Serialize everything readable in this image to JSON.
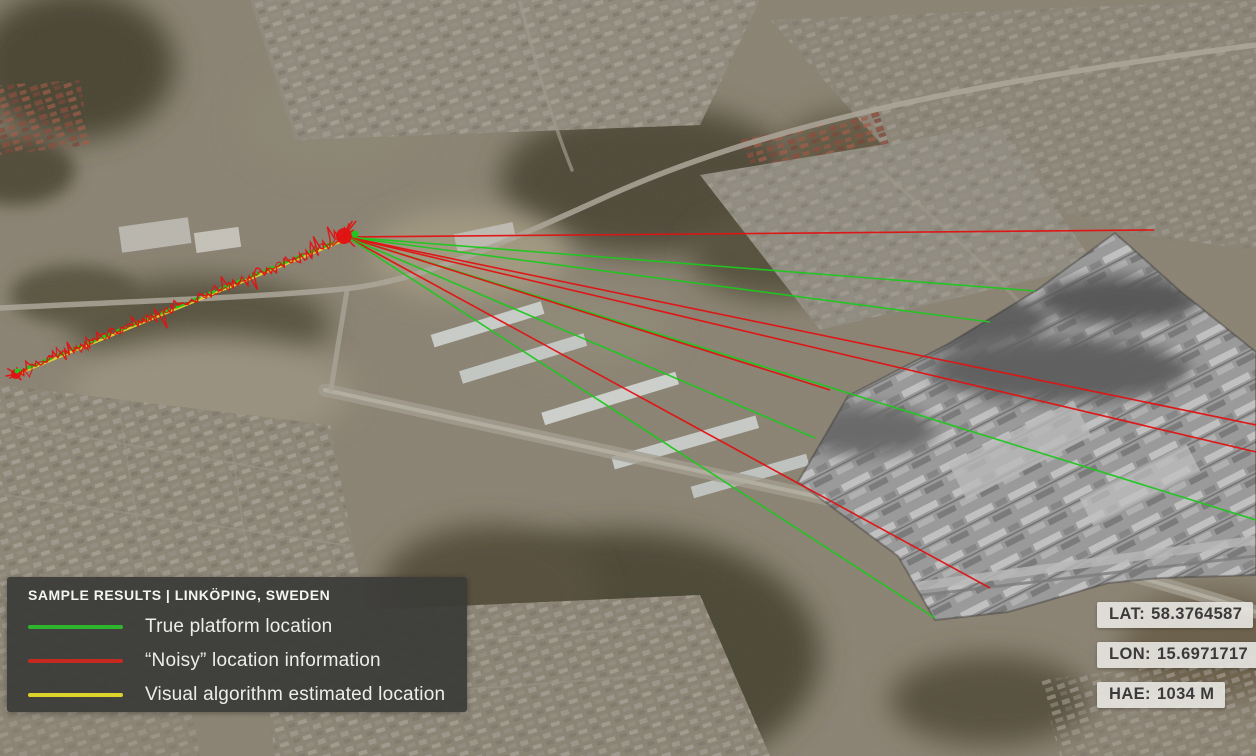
{
  "colors": {
    "green": "#1fc71f",
    "red": "#e11212",
    "yellow": "#e8da2e",
    "legend_bg": "rgba(60,59,56,0.94)",
    "badge_bg": "rgba(230,228,223,0.92)",
    "badge_text": "#3a3a3a"
  },
  "legend": {
    "title": "SAMPLE RESULTS | LINKÖPING, SWEDEN",
    "items": [
      {
        "label": "True platform location",
        "color": "#2db52d"
      },
      {
        "label": "“Noisy” location information",
        "color": "#c6291f"
      },
      {
        "label": "Visual algorithm estimated location",
        "color": "#ddd32b"
      }
    ]
  },
  "telemetry": {
    "badges": [
      {
        "label": "LAT:",
        "value": "58.3764587"
      },
      {
        "label": "LON:",
        "value": "15.6971717"
      },
      {
        "label": "HAE:",
        "value": "1034 M"
      }
    ]
  },
  "overlay": {
    "origin": {
      "x": 347,
      "y": 237
    },
    "rays": [
      {
        "color": "red",
        "x2": 1154,
        "y2": 230
      },
      {
        "color": "green",
        "x2": 1035,
        "y2": 291
      },
      {
        "color": "green",
        "x2": 990,
        "y2": 322
      },
      {
        "color": "red",
        "x2": 1256,
        "y2": 425
      },
      {
        "color": "red",
        "x2": 1256,
        "y2": 452
      },
      {
        "color": "green",
        "x2": 1256,
        "y2": 520
      },
      {
        "color": "red",
        "x2": 830,
        "y2": 390
      },
      {
        "color": "green",
        "x2": 815,
        "y2": 438
      },
      {
        "color": "red",
        "x2": 990,
        "y2": 588
      },
      {
        "color": "green",
        "x2": 935,
        "y2": 618
      }
    ],
    "track": {
      "x1": 347,
      "y1": 237,
      "x2": 15,
      "y2": 373
    },
    "noise": {
      "segments": 150,
      "amplitude": 6
    },
    "endpoint_clusters": [
      {
        "x": 344,
        "y": 236,
        "r": 8
      },
      {
        "x": 16,
        "y": 374,
        "r": 5
      }
    ]
  }
}
